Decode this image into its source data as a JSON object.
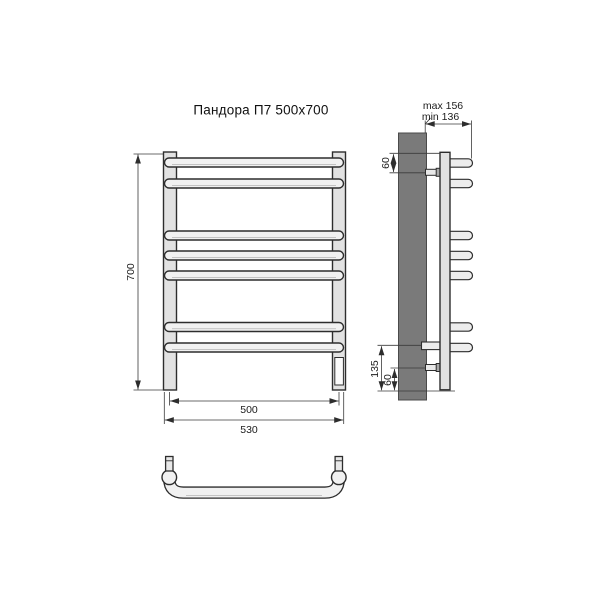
{
  "drawing": {
    "title": "Пандора П7 500x700",
    "front_view": {
      "height": "700",
      "axle_width": "500",
      "overall_width": "530"
    },
    "side_view": {
      "depth_max": "max 156",
      "depth_min": "min 136",
      "top_bracket_offset": "60",
      "bottom_section_height": "135",
      "bottom_bracket_offset": "60"
    },
    "colors": {
      "outline": "#2d2d2d",
      "wall": "#7a7a7a",
      "post_fill": "#e2e2e2",
      "bar_fill": "#f1f1f1"
    }
  }
}
